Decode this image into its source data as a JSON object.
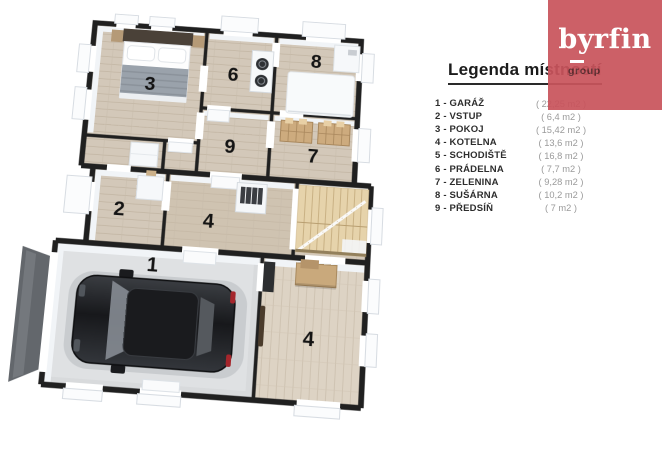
{
  "logo": {
    "brand": "byrfin",
    "group": "group",
    "bg_color": "#c9545c"
  },
  "legend": {
    "title": "Legenda místností",
    "items": [
      {
        "label": "1 - GARÁŽ",
        "area": "( 22,25 m2 )"
      },
      {
        "label": "2 - VSTUP",
        "area": "( 6,4 m2 )"
      },
      {
        "label": "3 - POKOJ",
        "area": "( 15,42 m2 )"
      },
      {
        "label": "4 - KOTELNA",
        "area": "( 13,6 m2 )"
      },
      {
        "label": "5 - SCHODIŠTĚ",
        "area": "( 16,8 m2 )"
      },
      {
        "label": "6 - PRÁDELNA",
        "area": "( 7,7 m2 )"
      },
      {
        "label": "7 - ZELENINA",
        "area": "( 9,28 m2 )"
      },
      {
        "label": "8 - SUŠÁRNA",
        "area": "( 10,2 m2 )"
      },
      {
        "label": "9 - PŘEDSÍŇ",
        "area": "( 7 m2 )"
      }
    ]
  },
  "plan": {
    "labels": [
      "3",
      "6",
      "8",
      "9",
      "7",
      "2",
      "4",
      "1",
      "4"
    ],
    "colors": {
      "wall": "#202020",
      "wood_floor": "#d3c8b9",
      "garage_floor": "#d8dadc",
      "stairs_wood": "#e6d3ab",
      "car_body": "#202226",
      "accent_red": "#c9545c"
    }
  }
}
